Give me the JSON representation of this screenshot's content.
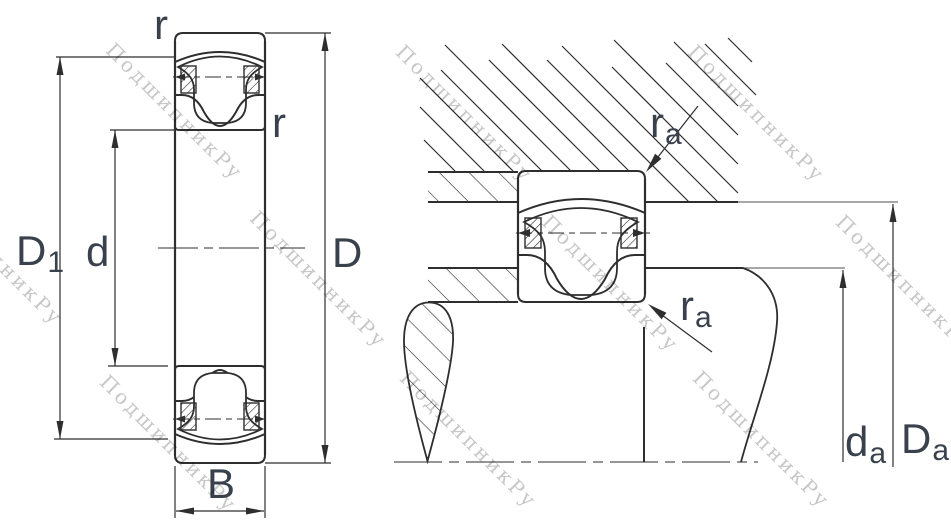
{
  "watermark": {
    "text": "ПодшипникРу",
    "color": "#c7c7c7"
  },
  "colors": {
    "line": "#2e2e2e",
    "thin_line": "#8a8a8a",
    "label": "#39414c",
    "watermark": "#c7c7c7",
    "background": "#ffffff"
  },
  "left_view": {
    "description": "barrel roller bearing cross-section",
    "labels": {
      "r_top": "r",
      "r_side": "r",
      "outer_land": {
        "main": "D",
        "sub": "1"
      },
      "bore": {
        "main": "d"
      },
      "outside": {
        "main": "D"
      },
      "width": {
        "main": "B"
      }
    }
  },
  "right_view": {
    "description": "bearing mounted between housing and shaft abutments",
    "labels": {
      "fillet_top": {
        "main": "r",
        "sub": "a"
      },
      "fillet_bottom": {
        "main": "r",
        "sub": "a"
      },
      "shaft_abutment": {
        "main": "d",
        "sub": "a"
      },
      "housing_abutment": {
        "main": "D",
        "sub": "a"
      }
    }
  }
}
